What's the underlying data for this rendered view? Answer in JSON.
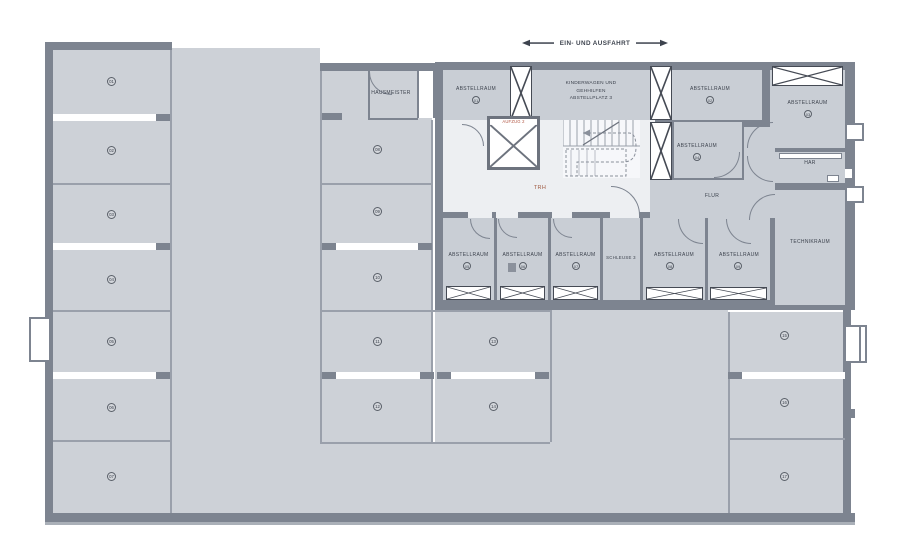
{
  "annotation": {
    "text": "EIN- UND AUSFAHRT"
  },
  "labels": {
    "hausmeister": "HAUSMEISTER",
    "kinderwagen": [
      "KINDERWAGEN UND",
      "GEHHILFEN",
      "ABSTELLPLATZ 3"
    ],
    "aufzug": "AUFZUG 2",
    "trh": "TRH",
    "flur": "FLUR",
    "har": "HAR",
    "schleuse": "SCHLEUSE 3",
    "technikraum": "TECHNIKRAUM"
  },
  "storage_rooms": [
    {
      "label": "ABSTELLRAUM",
      "number": "01"
    },
    {
      "label": "ABSTELLRAUM",
      "number": "02"
    },
    {
      "label": "ABSTELLRAUM",
      "number": "03"
    },
    {
      "label": "ABSTELLRAUM",
      "number": "04"
    },
    {
      "label": "ABSTELLRAUM",
      "number": "05"
    },
    {
      "label": "ABSTELLRAUM",
      "number": "06"
    },
    {
      "label": "ABSTELLRAUM",
      "number": "07"
    },
    {
      "label": "ABSTELLRAUM",
      "number": "08"
    },
    {
      "label": "ABSTELLRAUM",
      "number": "09"
    }
  ],
  "parking_stalls": {
    "left": [
      "01",
      "02",
      "03",
      "04",
      "05",
      "06",
      "07"
    ],
    "middle": [
      "08",
      "09",
      "10",
      "11",
      "12"
    ],
    "center": [
      "13",
      "14"
    ],
    "right": [
      "15",
      "16",
      "17"
    ]
  },
  "colors": {
    "wall": "#7d8490",
    "parking_area": "#cdd1d7",
    "room": "#c9ced5",
    "core": "#edeff2",
    "accent": "#a05a42"
  }
}
